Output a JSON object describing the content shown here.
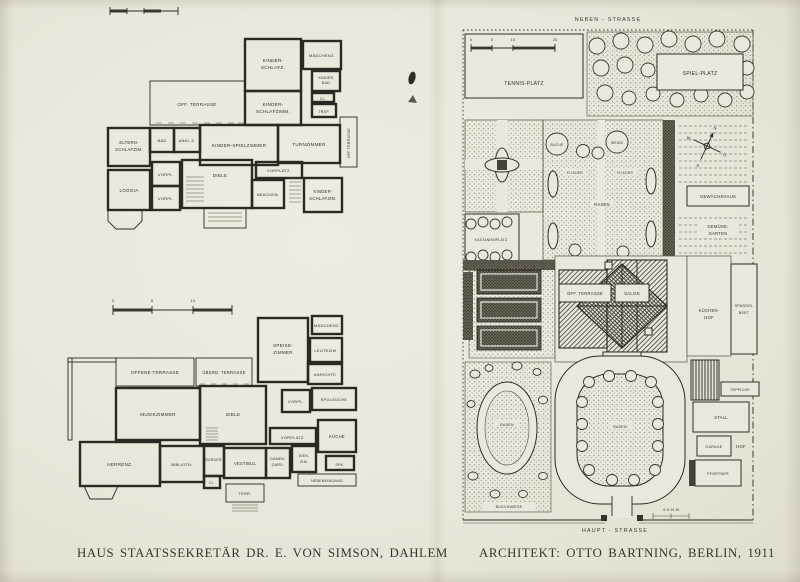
{
  "page": {
    "caption_left": "HAUS STAATSSEKRETÄR DR. E. VON SIMSON, DAHLEM",
    "caption_right": "ARCHITEKT: OTTO BARTNING, BERLIN, 1911"
  },
  "plan_upper": {
    "labels": {
      "kinder_schlafz": [
        "KINDER-",
        "SCHLAFZ."
      ],
      "maedchenz": "MÄDCHENZ.",
      "kinder_bad": [
        "KINDER",
        "BAD"
      ],
      "cl": "CL.",
      "trep": "TREP.",
      "off_terrasse": "OFF. TERRASSE",
      "kinder_schlafzimm": [
        "KINDER-",
        "SCHLAFZIMM."
      ],
      "eltern_schlafzim": [
        "ELTERN-",
        "SCHLAFZIM."
      ],
      "bad": "BAD",
      "ankl_z": "ANKL.Z.",
      "kinder_spielzimmer": "KINDER-SPIELZIMMER",
      "turnzimmer": "TURNZIMMER",
      "off_terrasse_vert": "OFF.TERRASSE",
      "loggia": "LOGGIA",
      "vorpl_1": "VORPL.",
      "vorpl_2": "VORPL.",
      "diele": "DIELE",
      "vorplatz": "VORPLATZ.",
      "maedchzim": "MÄDCHZIM.",
      "kinder_schlafzim_2": [
        "KINDER-",
        "SCHLAFZIM."
      ]
    }
  },
  "plan_ground": {
    "scale_ticks": [
      "0",
      "5",
      "10"
    ],
    "labels": {
      "maedchenz": "MÄDCHENZ.",
      "speise_zimmer": [
        "SPEISE-",
        "ZIMMER"
      ],
      "leutezim": "LEUTEZIM.",
      "anrichte": "ANRICHTE",
      "vorpl": "VORPL.",
      "spuelkueche": "SPÜLKÜCHE",
      "offene_terrasse": "OFFENE TERRASSE",
      "ueberd_terrasse": "ÜBERD. TERRASSE",
      "musikzimmer": "MUSIKZIMMER",
      "diele": "DIELE",
      "herrenz": "HERRENZ.",
      "bibliothek": "BIBLIOTH.",
      "garder": "GARDER.",
      "cl": "CL.",
      "vestibul": "VESTIBUL",
      "terr": "TERR.",
      "damen_gard": [
        "DAMEN-",
        "GARD."
      ],
      "dien_zim": [
        "DIEN.",
        "ZIM."
      ],
      "vorplatz": "VORPLATZ.",
      "kueche": "KÜCHE",
      "spk": "SPK.",
      "nebeneingang": "NEBENEINGANG"
    }
  },
  "site_plan": {
    "street_top": "NEBEN - STRASSE",
    "street_bottom": "HAUPT - STRASSE",
    "scale_ticks": [
      "0",
      "5",
      "10",
      "20"
    ],
    "scale_note": "0·5·10 M",
    "compass": {
      "n": "N",
      "e": "O",
      "s": "S",
      "w": "W"
    },
    "labels": {
      "tennis_platz": "TENNIS-PLATZ",
      "spiel_platz": "SPIEL-PLATZ",
      "buche": "BUCHE",
      "weide": "WEIDE",
      "rasen": "RASEN",
      "flieder": "FLIEDER",
      "kastanienplatz": "KASTANIENPLATZ",
      "gewaechshaus": "GEWÄCHSHAUS",
      "gemuese_garten": [
        "GEMÜSE-",
        "GARTEN"
      ],
      "off_terrasse": "OFF. TERRASSE",
      "salon": "SALON",
      "kuechen_hof": [
        "KÜCHEN-",
        "HOF"
      ],
      "spargel_beet": [
        "SPARGEL",
        "BEET"
      ],
      "teppiche": "TEPPICHE",
      "stall": "STALL",
      "garage": "GARAGE",
      "hof": "HOF",
      "pfoertner": "PFÖRTNER",
      "rasen_sw": "RASEN",
      "rasen_drive": "RASEN",
      "buschwiese": "BUSCHWIESE"
    }
  }
}
